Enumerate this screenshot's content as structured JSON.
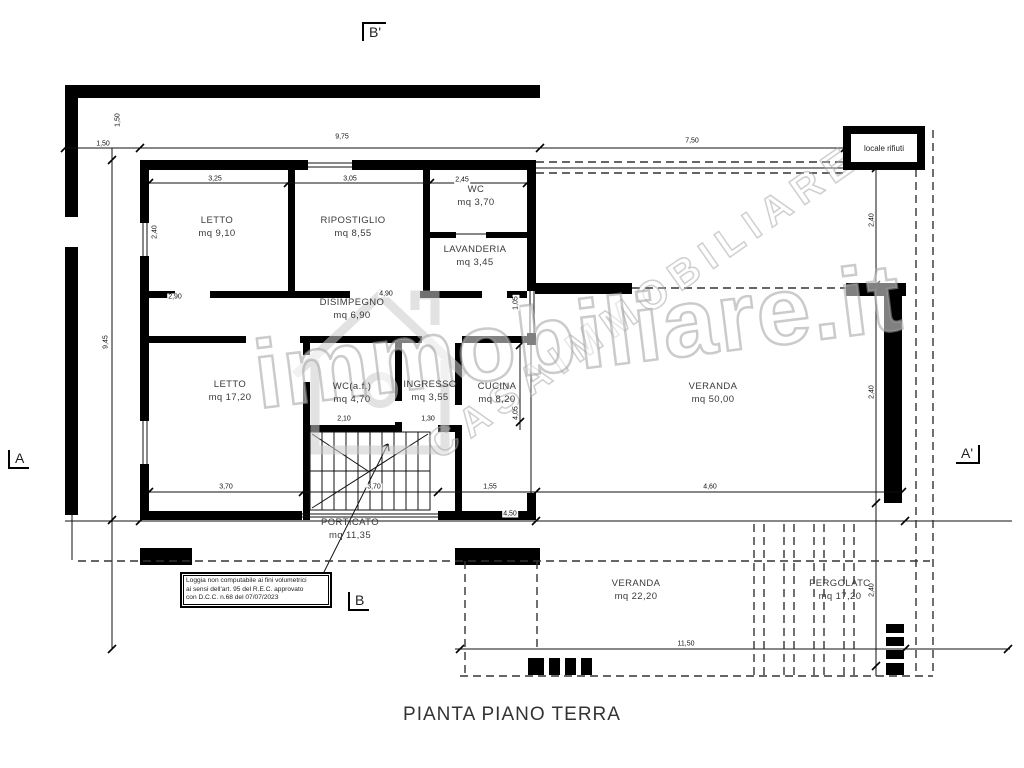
{
  "page_title": "PIANTA PIANO TERRA",
  "section_markers": {
    "top": "B'",
    "bottom": "B",
    "left": "A",
    "right": "A'"
  },
  "locale_rifiuti_label": "locale rifiuti",
  "note_box": {
    "lines": [
      "Loggia non computabile ai fini volumetrici",
      "ai sensi dell'art. 95 del R.E.C. approvato",
      "con D.C.C. n.68 del 07/07/2023"
    ]
  },
  "watermark": {
    "primary": "immobiliare.it",
    "secondary": "CASAIMMOBILIARE"
  },
  "colors": {
    "walls": "#000000",
    "dashed_lines": "#333333",
    "watermark": "#c4c4c4",
    "text": "#3a3a3a"
  },
  "rooms": [
    {
      "name": "LETTO",
      "area": "mq 9,10",
      "x": 217,
      "y": 228
    },
    {
      "name": "RIPOSTIGLIO",
      "area": "mq 8,55",
      "x": 353,
      "y": 228
    },
    {
      "name": "WC",
      "area": "mq 3,70",
      "x": 476,
      "y": 197
    },
    {
      "name": "LAVANDERIA",
      "area": "mq 3,45",
      "x": 475,
      "y": 257
    },
    {
      "name": "DISIMPEGNO",
      "area": "mq 6,90",
      "x": 352,
      "y": 310
    },
    {
      "name": "LETTO",
      "area": "mq 17,20",
      "x": 230,
      "y": 392
    },
    {
      "name": "WC(a.f.)",
      "area": "mq 4,70",
      "x": 352,
      "y": 394
    },
    {
      "name": "INGRESSO",
      "area": "mq 3,55",
      "x": 430,
      "y": 392
    },
    {
      "name": "CUCINA",
      "area": "mq 8,20",
      "x": 497,
      "y": 394
    },
    {
      "name": "VERANDA",
      "area": "mq 50,00",
      "x": 713,
      "y": 394
    },
    {
      "name": "PORTICATO",
      "area": "mq 11,35",
      "x": 350,
      "y": 530
    },
    {
      "name": "VERANDA",
      "area": "mq 22,20",
      "x": 636,
      "y": 591
    },
    {
      "name": "PERGOLATO",
      "area": "mq 17,20",
      "x": 840,
      "y": 591
    }
  ],
  "dimensions": [
    {
      "text": "1,50",
      "x": 103,
      "y": 144,
      "rot": 0
    },
    {
      "text": "9,75",
      "x": 342,
      "y": 137,
      "rot": 0
    },
    {
      "text": "7,50",
      "x": 692,
      "y": 141,
      "rot": 0
    },
    {
      "text": "3,25",
      "x": 215,
      "y": 179,
      "rot": 0
    },
    {
      "text": "3,05",
      "x": 350,
      "y": 179,
      "rot": 0
    },
    {
      "text": "2,45",
      "x": 462,
      "y": 180,
      "rot": 0
    },
    {
      "text": "1,50",
      "x": 118,
      "y": 120,
      "rot": 1
    },
    {
      "text": "2,40",
      "x": 155,
      "y": 232,
      "rot": 1
    },
    {
      "text": "2,90",
      "x": 175,
      "y": 297,
      "rot": 0
    },
    {
      "text": "4,90",
      "x": 386,
      "y": 294,
      "rot": 0
    },
    {
      "text": "9,45",
      "x": 106,
      "y": 342,
      "rot": 1
    },
    {
      "text": "3,70",
      "x": 226,
      "y": 487,
      "rot": 0
    },
    {
      "text": "3,70",
      "x": 374,
      "y": 487,
      "rot": 0
    },
    {
      "text": "1,55",
      "x": 490,
      "y": 487,
      "rot": 0
    },
    {
      "text": "2,10",
      "x": 344,
      "y": 419,
      "rot": 0
    },
    {
      "text": "1,30",
      "x": 428,
      "y": 419,
      "rot": 0
    },
    {
      "text": "1,05",
      "x": 516,
      "y": 303,
      "rot": 1
    },
    {
      "text": "4,05",
      "x": 516,
      "y": 413,
      "rot": 1
    },
    {
      "text": "4,50",
      "x": 510,
      "y": 514,
      "rot": 0
    },
    {
      "text": "4,60",
      "x": 710,
      "y": 487,
      "rot": 0
    },
    {
      "text": "2,40",
      "x": 872,
      "y": 220,
      "rot": 1
    },
    {
      "text": "2,40",
      "x": 872,
      "y": 392,
      "rot": 1
    },
    {
      "text": "2,40",
      "x": 872,
      "y": 590,
      "rot": 1
    },
    {
      "text": "11,50",
      "x": 686,
      "y": 644,
      "rot": 0
    }
  ]
}
